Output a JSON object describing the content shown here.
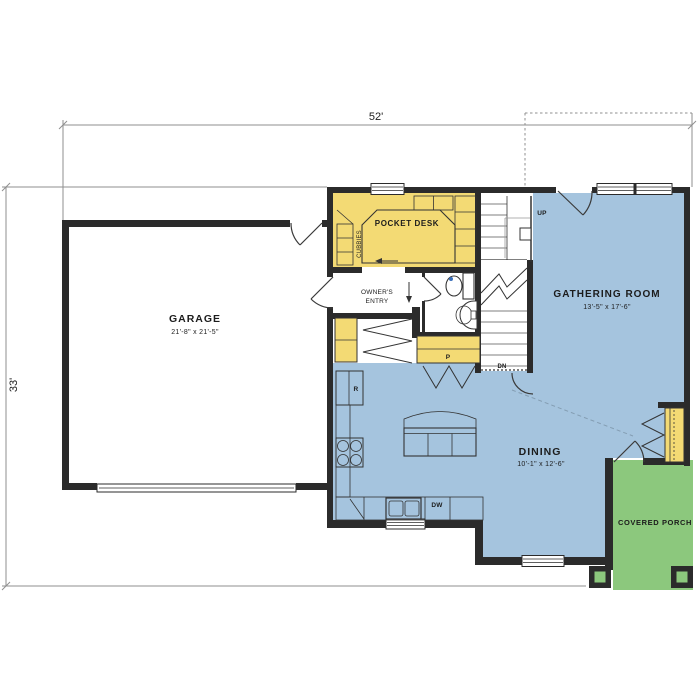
{
  "plan": {
    "overall": {
      "width_label": "52'",
      "height_label": "33'"
    },
    "rooms": {
      "garage": {
        "name": "GARAGE",
        "size": "21'-8\" x 21'-5\""
      },
      "gathering": {
        "name": "GATHERING ROOM",
        "size": "13'-5\" x 17'-6\""
      },
      "dining": {
        "name": "DINING",
        "size": "10'-1\" x 12'-6\""
      },
      "porch": {
        "name": "COVERED PORCH"
      },
      "pocket_desk": {
        "name": "POCKET DESK"
      },
      "cubbies": {
        "name": "CUBBIES"
      },
      "owners_entry": {
        "line1": "OWNER'S",
        "line2": "ENTRY"
      }
    },
    "tags": {
      "pantry": "P",
      "refrigerator": "R",
      "dishwasher": "DW",
      "stairs_up": "UP",
      "stairs_down": "DN"
    },
    "colors": {
      "room_yellow": "#F3DA74",
      "room_blue": "#A5C4DE",
      "porch_green": "#8CC87D",
      "wall": "#2B2B2B",
      "dimension": "#8F8F8F"
    }
  }
}
